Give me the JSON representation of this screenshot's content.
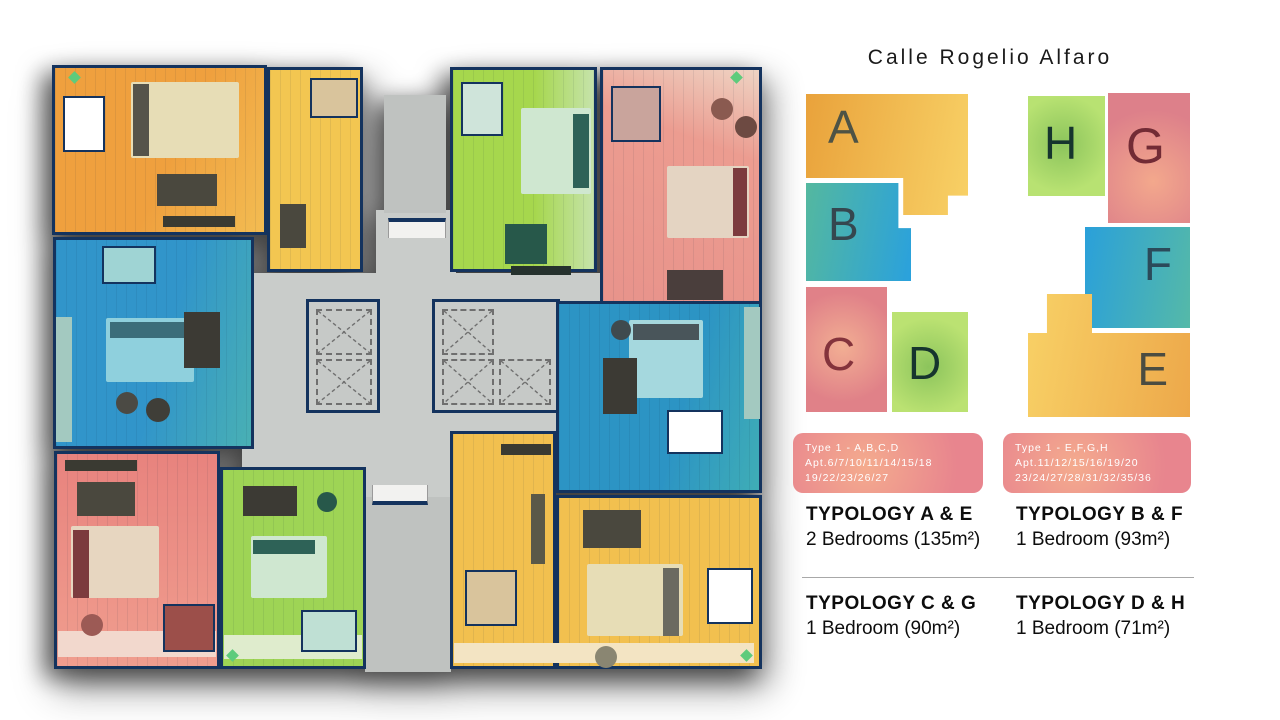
{
  "title": "Calle Rogelio Alfaro",
  "legend": {
    "blocks": [
      {
        "id": "A",
        "letter": "A",
        "fill": "linear-gradient(100deg,#e9a23b,#f8d166)",
        "letter_color": "#4e5345"
      },
      {
        "id": "B",
        "letter": "B",
        "fill": "linear-gradient(100deg,#54b89f,#2aa1dd)",
        "letter_color": "#35474f"
      },
      {
        "id": "C",
        "letter": "C",
        "fill": "radial-gradient(circle at 45% 48%,#f2ae93,#e08188 70%)",
        "letter_color": "#84333c"
      },
      {
        "id": "D",
        "letter": "D",
        "fill": "radial-gradient(circle at 48% 55%,#8cc45c,#bbe272 72%)",
        "letter_color": "#16352e"
      },
      {
        "id": "H",
        "letter": "H",
        "fill": "radial-gradient(circle at 45% 48%,#8cc45c,#b8e272 72%)",
        "letter_color": "#16352e"
      },
      {
        "id": "G",
        "letter": "G",
        "fill": "radial-gradient(circle at 55% 68%,#f3a88c,#dd808a 72%)",
        "letter_color": "#722b35"
      },
      {
        "id": "F",
        "letter": "F",
        "fill": "linear-gradient(100deg,#2aa0da,#55b9a8)",
        "letter_color": "#2b4a5a"
      },
      {
        "id": "E",
        "letter": "E",
        "fill": "linear-gradient(100deg,#f8d166,#eda84a)",
        "letter_color": "#4b4c41"
      }
    ],
    "type_badges": [
      {
        "line1": "Type 1 - A,B,C,D",
        "line2": "Apt.6/7/10/11/14/15/18",
        "line3": "19/22/23/26/27"
      },
      {
        "line1": "Type 1 - E,F,G,H",
        "line2": "Apt.11/12/15/16/19/20",
        "line3": "23/24/27/28/31/32/35/36"
      }
    ],
    "badge_fill": "radial-gradient(circle at 38% 55%,#f4ab8e,#e8858e 75%)",
    "typologies": [
      {
        "title": "TYPOLOGY A & E",
        "detail": "2 Bedrooms (135m²)"
      },
      {
        "title": "TYPOLOGY B & F",
        "detail": "1 Bedroom (93m²)"
      },
      {
        "title": "TYPOLOGY C & G",
        "detail": "1 Bedroom (90m²)"
      },
      {
        "title": "TYPOLOGY D & H",
        "detail": "1 Bedroom (71m²)"
      }
    ]
  },
  "floorplan": {
    "colors": {
      "wall": "#14335e",
      "core": "#c9ccca",
      "stair": "#bfc2c0",
      "cabinet": "#f2f2f0",
      "a": "linear-gradient(115deg,#efa03e 55%,#f3bc52)",
      "top_yellow": "#f3c651",
      "h": "linear-gradient(90deg,#a6d74d 58%,#c6e3ab)",
      "g": "linear-gradient(200deg,#eed3c3,#ec9c90 32%,#e8938b)",
      "b": "linear-gradient(105deg,#3195ca 55%,#49b0b4)",
      "f": "linear-gradient(105deg,#2c94c4 60%,#3fadb6)",
      "c": "linear-gradient(180deg,#e8837e,#f09d8e)",
      "d": "#9ed455",
      "e": "#f2c04f",
      "balcony_teal": "#a3c9c0",
      "terrace_pink": "#f2d8cd",
      "terrace_green": "#dfeccd",
      "terrace_sand": "#f3e4c3"
    }
  }
}
